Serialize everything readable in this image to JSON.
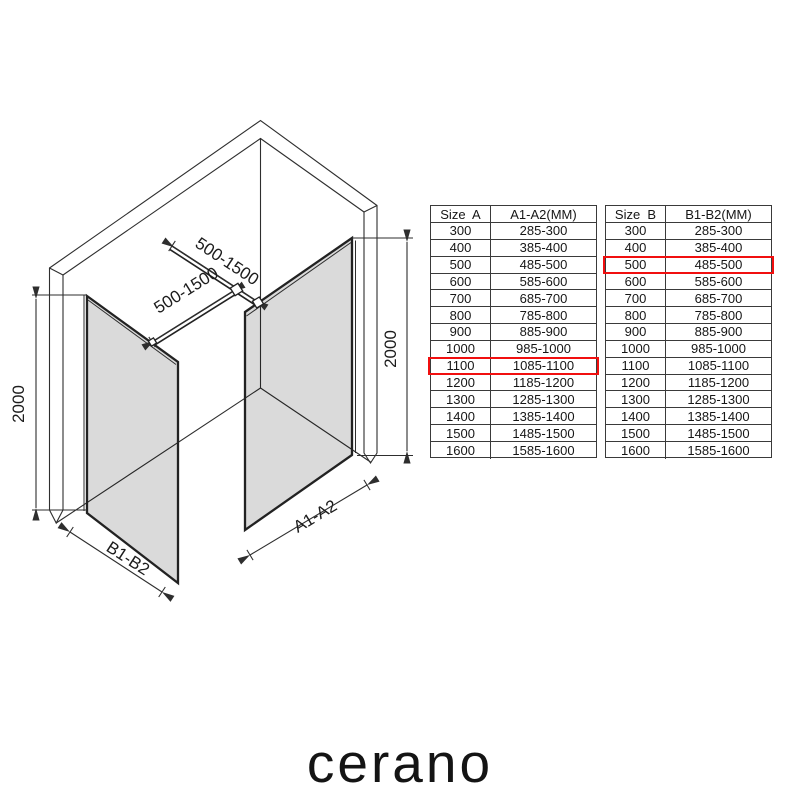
{
  "diagram": {
    "labels": {
      "bar_upper": "500-1500",
      "bar_lower": "500-1500",
      "height_left": "2000",
      "height_right": "2000",
      "width_a": "A1-A2",
      "width_b": "B1-B2"
    }
  },
  "tables": {
    "a": {
      "col1": "Size  A",
      "col2": "A1-A2(MM)",
      "rows": [
        {
          "size": "300",
          "range": "285-300"
        },
        {
          "size": "400",
          "range": "385-400"
        },
        {
          "size": "500",
          "range": "485-500"
        },
        {
          "size": "600",
          "range": "585-600"
        },
        {
          "size": "700",
          "range": "685-700"
        },
        {
          "size": "800",
          "range": "785-800"
        },
        {
          "size": "900",
          "range": "885-900"
        },
        {
          "size": "1000",
          "range": "985-1000"
        },
        {
          "size": "1100",
          "range": "1085-1100",
          "hl": true
        },
        {
          "size": "1200",
          "range": "1185-1200"
        },
        {
          "size": "1300",
          "range": "1285-1300"
        },
        {
          "size": "1400",
          "range": "1385-1400"
        },
        {
          "size": "1500",
          "range": "1485-1500"
        },
        {
          "size": "1600",
          "range": "1585-1600"
        }
      ]
    },
    "b": {
      "col1": "Size  B",
      "col2": "B1-B2(MM)",
      "rows": [
        {
          "size": "300",
          "range": "285-300"
        },
        {
          "size": "400",
          "range": "385-400"
        },
        {
          "size": "500",
          "range": "485-500",
          "hl": true
        },
        {
          "size": "600",
          "range": "585-600"
        },
        {
          "size": "700",
          "range": "685-700"
        },
        {
          "size": "800",
          "range": "785-800"
        },
        {
          "size": "900",
          "range": "885-900"
        },
        {
          "size": "1000",
          "range": "985-1000"
        },
        {
          "size": "1100",
          "range": "1085-1100"
        },
        {
          "size": "1200",
          "range": "1185-1200"
        },
        {
          "size": "1300",
          "range": "1285-1300"
        },
        {
          "size": "1400",
          "range": "1385-1400"
        },
        {
          "size": "1500",
          "range": "1485-1500"
        },
        {
          "size": "1600",
          "range": "1585-1600"
        }
      ]
    }
  },
  "brand": {
    "logo": "cerano"
  },
  "colors": {
    "highlight": "#f10f0f",
    "line": "#2e2e2e",
    "glass": "#d9d9d9"
  }
}
